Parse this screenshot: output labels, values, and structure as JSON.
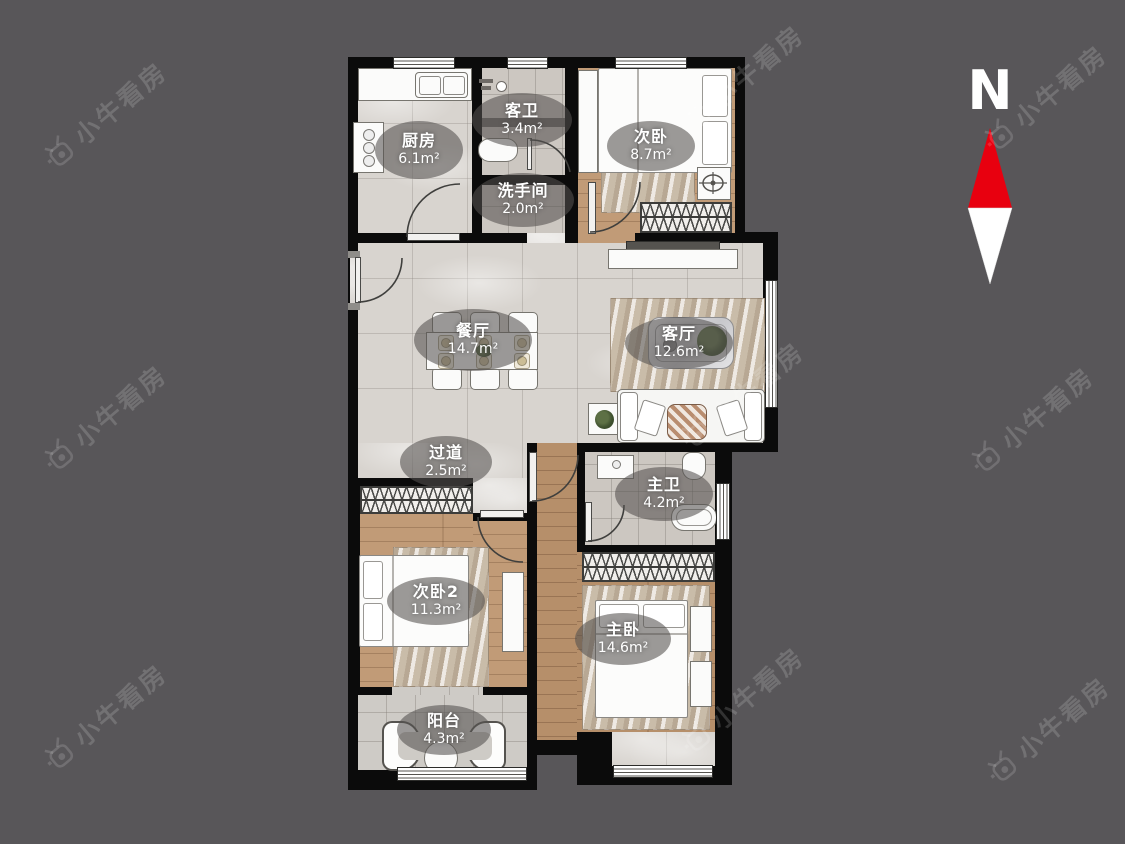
{
  "compass": {
    "label": "N",
    "arrow_red": "#e8000f",
    "arrow_white": "#ffffff"
  },
  "watermark": {
    "text": "小牛看房"
  },
  "rooms": [
    {
      "id": "kitchen",
      "name": "厨房",
      "area": "6.1m²"
    },
    {
      "id": "guest-bath",
      "name": "客卫",
      "area": "3.4m²"
    },
    {
      "id": "bedroom-second",
      "name": "次卧",
      "area": "8.7m²"
    },
    {
      "id": "washroom",
      "name": "洗手间",
      "area": "2.0m²"
    },
    {
      "id": "dining-room",
      "name": "餐厅",
      "area": "14.7m²"
    },
    {
      "id": "living-room",
      "name": "客厅",
      "area": "12.6m²"
    },
    {
      "id": "hallway",
      "name": "过道",
      "area": "2.5m²"
    },
    {
      "id": "master-bath",
      "name": "主卫",
      "area": "4.2m²"
    },
    {
      "id": "bedroom-second2",
      "name": "次卧2",
      "area": "11.3m²"
    },
    {
      "id": "master-bedroom",
      "name": "主卧",
      "area": "14.6m²"
    },
    {
      "id": "balcony",
      "name": "阳台",
      "area": "4.3m²"
    }
  ]
}
